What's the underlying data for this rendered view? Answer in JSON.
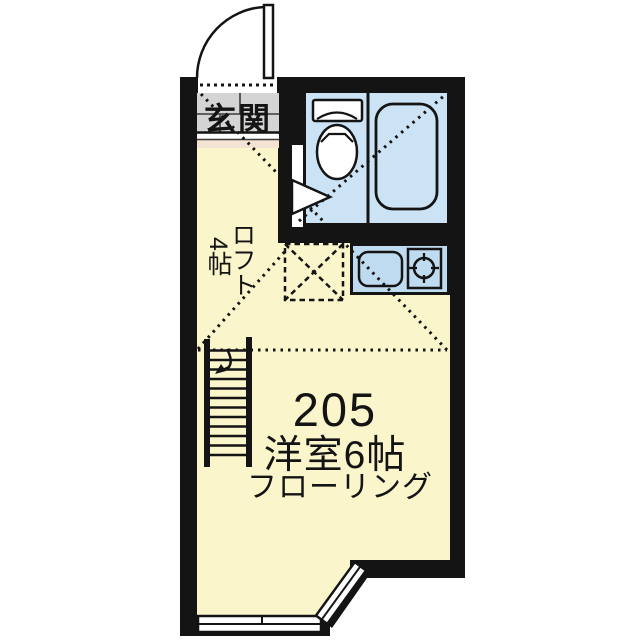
{
  "plan": {
    "unit_number": "205",
    "room_label": "洋室6帖",
    "flooring_label": "フローリング",
    "entrance_label": "玄関",
    "loft_label": "ロフト",
    "loft_size_label": "4帖"
  },
  "colors": {
    "wall": "#141414",
    "room_yellow": "#faf5cb",
    "bath_blue": "#cbe3f4",
    "kitchen_blue": "#bfdbf0",
    "genkan_gray": "#d4d4d4",
    "step_pink": "#f4e2d3",
    "paper_white": "#ffffff"
  }
}
